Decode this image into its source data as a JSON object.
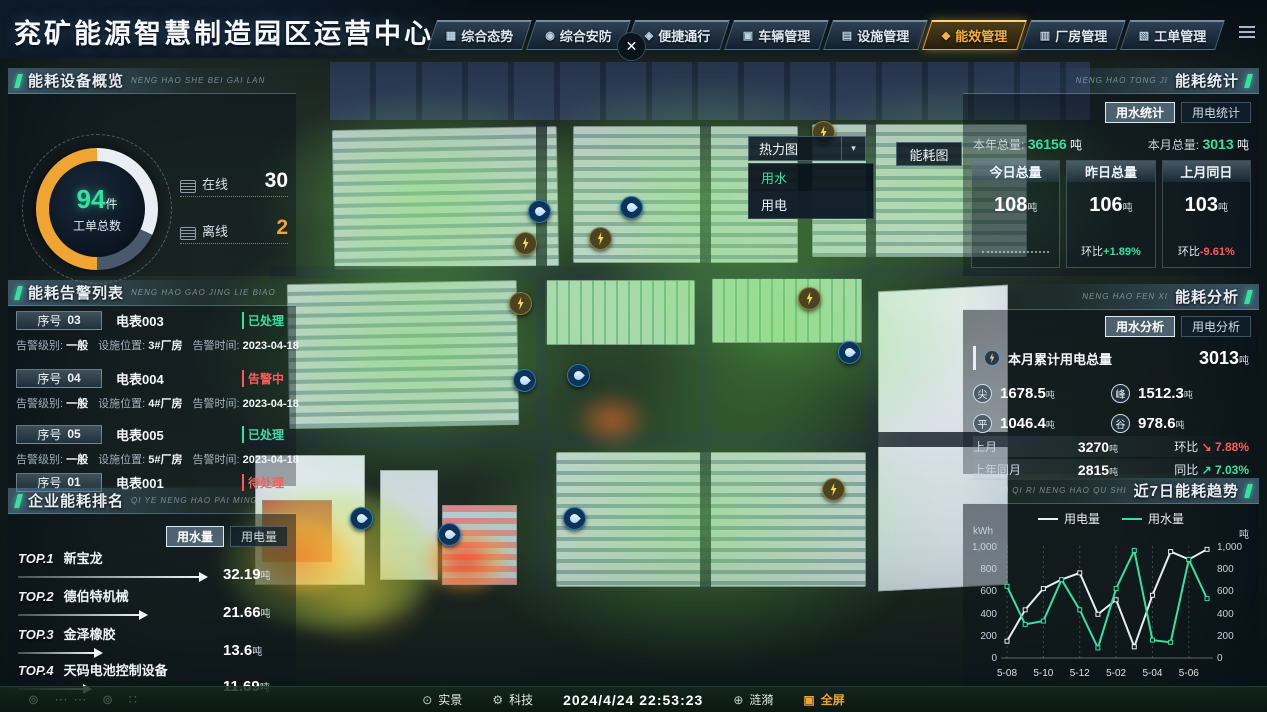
{
  "header": {
    "title": "兖矿能源智慧制造园区运营中心",
    "close_label": "✕",
    "tabs": [
      {
        "label": "综合态势",
        "icon": "situation-icon",
        "active": false
      },
      {
        "label": "综合安防",
        "icon": "security-icon",
        "active": false
      },
      {
        "label": "便捷通行",
        "icon": "access-icon",
        "active": false
      },
      {
        "label": "车辆管理",
        "icon": "vehicle-icon",
        "active": false
      },
      {
        "label": "设施管理",
        "icon": "facility-icon",
        "active": false
      },
      {
        "label": "能效管理",
        "icon": "energy-icon",
        "active": true
      },
      {
        "label": "厂房管理",
        "icon": "plant-icon",
        "active": false
      },
      {
        "label": "工单管理",
        "icon": "workorder-icon",
        "active": false
      }
    ]
  },
  "device_overview": {
    "title": "能耗设备概览",
    "subtitle": "NENG HAO SHE BEI GAI LAN",
    "gauge": {
      "value": "94",
      "unit": "件",
      "label": "工单总数"
    },
    "stats": [
      {
        "label": "在线",
        "value": "30",
        "warn": false
      },
      {
        "label": "离线",
        "value": "2",
        "warn": true
      }
    ]
  },
  "alarm_list": {
    "title": "能耗告警列表",
    "subtitle": "NENG HAO GAO JING LIE BIAO",
    "seq_label": "序号",
    "level_label": "告警级别:",
    "loc_label": "设施位置:",
    "time_label": "告警时间:",
    "items": [
      {
        "seq": "03",
        "device": "电表003",
        "status": "已处理",
        "status_type": "ok",
        "level": "一般",
        "location": "3#厂房",
        "time": "2023-04-18",
        "partial": false
      },
      {
        "seq": "04",
        "device": "电表004",
        "status": "告警中",
        "status_type": "alarm",
        "level": "一般",
        "location": "4#厂房",
        "time": "2023-04-18",
        "partial": false
      },
      {
        "seq": "05",
        "device": "电表005",
        "status": "已处理",
        "status_type": "ok",
        "level": "一般",
        "location": "5#厂房",
        "time": "2023-04-18",
        "partial": false
      },
      {
        "seq": "01",
        "device": "电表001",
        "status": "待处理",
        "status_type": "pending",
        "level": "",
        "location": "",
        "time": "",
        "partial": true
      }
    ]
  },
  "ranking": {
    "title": "企业能耗排名",
    "subtitle": "QI YE NENG HAO PAI MING",
    "toggles": [
      {
        "label": "用水量",
        "active": true
      },
      {
        "label": "用电量",
        "active": false
      }
    ],
    "unit": "吨",
    "items": [
      {
        "rank": "TOP.1",
        "name": "新宝龙",
        "value": "32.19"
      },
      {
        "rank": "TOP.2",
        "name": "德伯特机械",
        "value": "21.66"
      },
      {
        "rank": "TOP.3",
        "name": "金泽橡胶",
        "value": "13.6"
      },
      {
        "rank": "TOP.4",
        "name": "天码电池控制设备",
        "value": "11.69"
      }
    ]
  },
  "energy_stats": {
    "title": "能耗统计",
    "subtitle": "NENG HAO TONG JI",
    "tabs": [
      {
        "label": "用水统计",
        "active": true
      },
      {
        "label": "用电统计",
        "active": false
      }
    ],
    "year_label": "本年总量:",
    "year_value": "36156",
    "year_unit": "吨",
    "month_label": "本月总量:",
    "month_value": "3013",
    "month_unit": "吨",
    "columns": [
      {
        "label": "今日总量",
        "value": "108",
        "unit": "吨",
        "delta_label": "",
        "delta": "",
        "delta_type": "dots"
      },
      {
        "label": "昨日总量",
        "value": "106",
        "unit": "吨",
        "delta_label": "环比",
        "delta": "+1.89%",
        "delta_type": "up"
      },
      {
        "label": "上月同日",
        "value": "103",
        "unit": "吨",
        "delta_label": "环比",
        "delta": "-9.61%",
        "delta_type": "down"
      }
    ]
  },
  "energy_analysis": {
    "title": "能耗分析",
    "subtitle": "NENG HAO FEN XI",
    "tabs": [
      {
        "label": "用水分析",
        "active": true
      },
      {
        "label": "用电分析",
        "active": false
      }
    ],
    "total_label": "本月累计用电总量",
    "total_value": "3013",
    "total_unit": "吨",
    "tou": [
      {
        "key": "尖",
        "value": "1678.5",
        "unit": "吨"
      },
      {
        "key": "峰",
        "value": "1512.3",
        "unit": "吨"
      },
      {
        "key": "平",
        "value": "1046.4",
        "unit": "吨"
      },
      {
        "key": "谷",
        "value": "978.6",
        "unit": "吨"
      }
    ],
    "compare_rows": [
      {
        "label": "上月",
        "value": "3270",
        "unit": "吨",
        "cmp_label": "环比",
        "pct": "7.88%",
        "type": "down"
      },
      {
        "label": "上年同月",
        "value": "2815",
        "unit": "吨",
        "cmp_label": "同比",
        "pct": "7.03%",
        "type": "up"
      }
    ]
  },
  "trend": {
    "title": "近7日能耗趋势",
    "subtitle": "JIN QI RI NENG HAO QU SHI"
  },
  "chart_data": {
    "type": "line",
    "title": "近7日能耗趋势",
    "ylabel_left": "kWh",
    "ylabel_right": "吨",
    "ylim": [
      0,
      1000
    ],
    "yticks": [
      "1,000",
      "800",
      "600",
      "400",
      "200",
      "0"
    ],
    "categories": [
      "5-08",
      "5-10",
      "5-12",
      "5-02",
      "5-04",
      "5-06"
    ],
    "category_point_indices": [
      0,
      2,
      4,
      6,
      8,
      10
    ],
    "series": [
      {
        "name": "用电量",
        "color": "#e6edf3",
        "values": [
          150,
          430,
          620,
          700,
          760,
          390,
          520,
          100,
          560,
          950,
          880,
          970
        ]
      },
      {
        "name": "用水量",
        "color": "#35e2a2",
        "values": [
          640,
          300,
          330,
          700,
          430,
          90,
          620,
          960,
          160,
          140,
          880,
          530
        ]
      }
    ],
    "legend_position": "top",
    "grid": "vertical-dotted"
  },
  "map": {
    "dropdown": {
      "label": "热力图",
      "arrow": "▾",
      "options": [
        {
          "label": "用水",
          "active": true
        },
        {
          "label": "用电",
          "active": false
        }
      ]
    },
    "energy_map_button": "能耗图",
    "icons": [
      {
        "type": "water",
        "x": 528,
        "y": 200
      },
      {
        "type": "water",
        "x": 620,
        "y": 196
      },
      {
        "type": "water",
        "x": 513,
        "y": 369
      },
      {
        "type": "water",
        "x": 567,
        "y": 364
      },
      {
        "type": "water",
        "x": 838,
        "y": 341
      },
      {
        "type": "water",
        "x": 350,
        "y": 507
      },
      {
        "type": "water",
        "x": 438,
        "y": 523
      },
      {
        "type": "water",
        "x": 563,
        "y": 507
      },
      {
        "type": "power",
        "x": 514,
        "y": 232
      },
      {
        "type": "power",
        "x": 589,
        "y": 227
      },
      {
        "type": "power",
        "x": 798,
        "y": 287
      },
      {
        "type": "power",
        "x": 509,
        "y": 292
      },
      {
        "type": "power",
        "x": 822,
        "y": 478
      },
      {
        "type": "power",
        "x": 812,
        "y": 121
      }
    ]
  },
  "footer": {
    "left_buttons": [
      {
        "label": "实景",
        "icon": "scene-icon"
      },
      {
        "label": "科技",
        "icon": "tech-icon"
      }
    ],
    "datetime": "2024/4/24 22:53:23",
    "right_buttons": [
      {
        "label": "涟漪",
        "icon": "ripple-icon",
        "accent": false
      },
      {
        "label": "全屏",
        "icon": "fullscreen-icon",
        "accent": true
      }
    ]
  },
  "colors": {
    "accent_green": "#35e2a2",
    "accent_orange": "#f0a432",
    "alarm_red": "#ff5a5a",
    "electric_series": "#e6edf3",
    "water_series": "#35e2a2"
  }
}
